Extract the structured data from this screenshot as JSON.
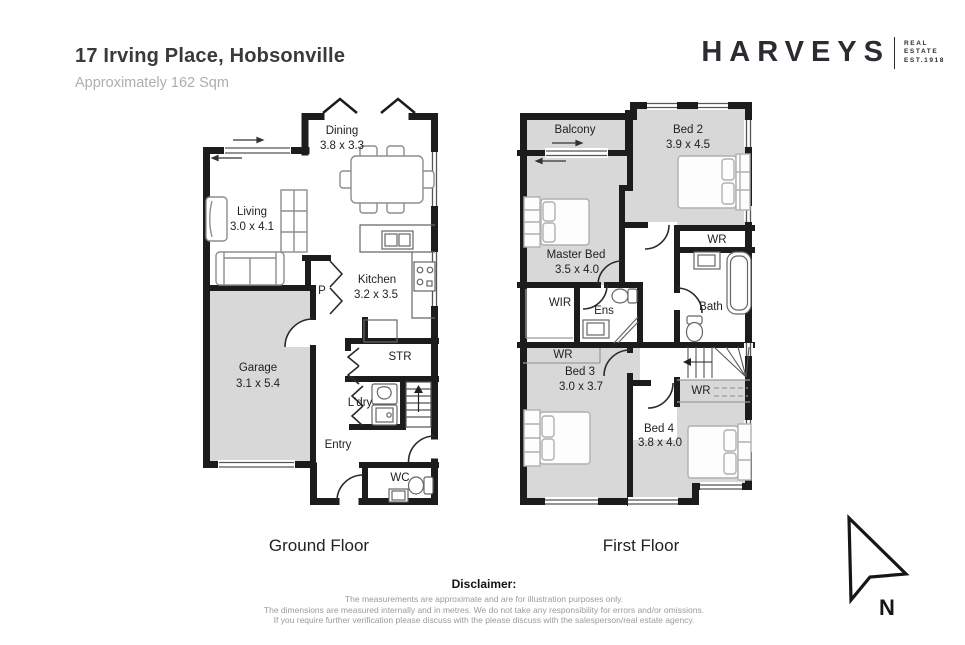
{
  "header": {
    "title": "17 Irving Place, Hobsonville",
    "subtitle": "Approximately 162 Sqm"
  },
  "logo": {
    "brand": "HARVEYS",
    "tagline_lines": [
      "REAL",
      "ESTATE",
      "EST.1918"
    ]
  },
  "floors": [
    {
      "title": "Ground Floor",
      "rooms": [
        {
          "label": "Dining",
          "dims": "3.8 x 3.3"
        },
        {
          "label": "Living",
          "dims": "3.0 x 4.1"
        },
        {
          "label": "Kitchen",
          "dims": "3.2 x 3.5"
        },
        {
          "label": "P"
        },
        {
          "label": "Garage",
          "dims": "3.1 x 5.4"
        },
        {
          "label": "STR"
        },
        {
          "label": "L'dry"
        },
        {
          "label": "Entry"
        },
        {
          "label": "WC"
        }
      ]
    },
    {
      "title": "First Floor",
      "rooms": [
        {
          "label": "Balcony"
        },
        {
          "label": "Bed 2",
          "dims": "3.9 x 4.5"
        },
        {
          "label": "Master Bed",
          "dims": "3.5 x 4.0"
        },
        {
          "label": "WIR"
        },
        {
          "label": "Ens"
        },
        {
          "label": "WR"
        },
        {
          "label": "Bath"
        },
        {
          "label": "WR"
        },
        {
          "label": "Bed 3",
          "dims": "3.0 x 3.7"
        },
        {
          "label": "WR"
        },
        {
          "label": "Bed 4",
          "dims": "3.8 x 4.0"
        }
      ]
    }
  ],
  "compass": {
    "label": "N"
  },
  "disclaimer": {
    "heading": "Disclaimer:",
    "lines": [
      "The measurements are approximate and are for illustration purposes only.",
      "The dimensions are measured internally and in metres. We do not take any responsibility for errors and/or omissions.",
      "If you require further verification please discuss with the please discuss with the salesperson/real estate agency."
    ]
  },
  "colors": {
    "wall": "#1c1c1c",
    "room_fill": "#d8d8d8",
    "furniture": "#8d8d8d"
  }
}
